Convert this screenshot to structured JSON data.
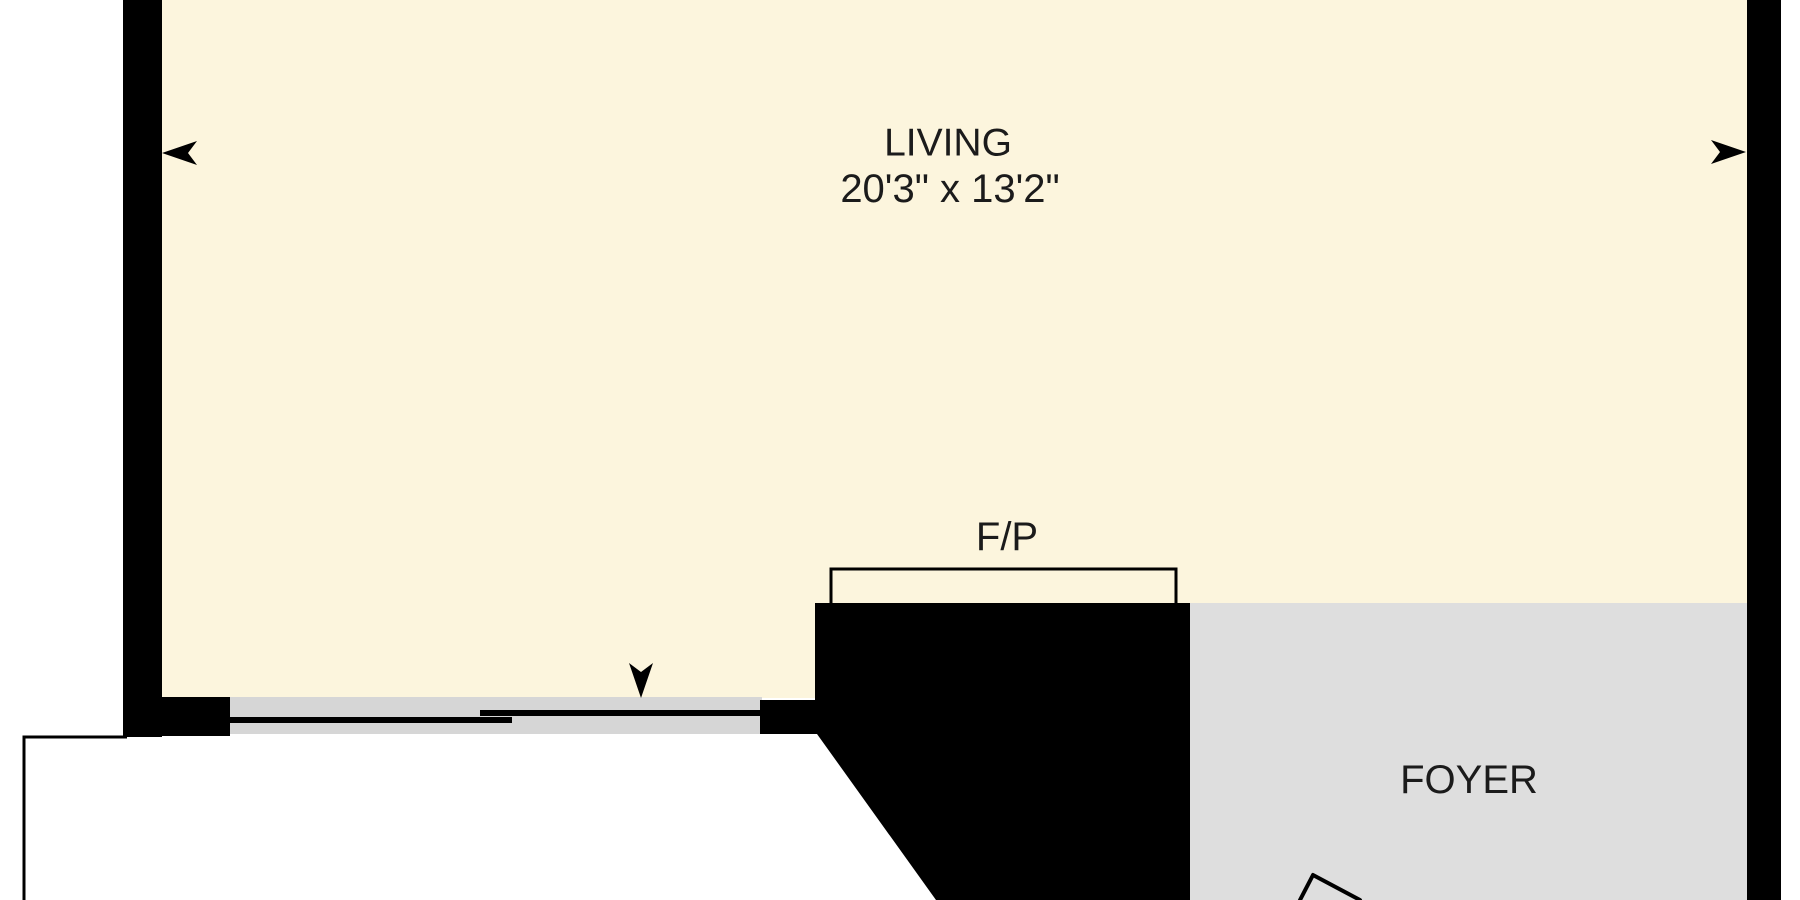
{
  "floor_plan": {
    "rooms": {
      "living": {
        "label": "LIVING",
        "dimensions": "20'3\" x 13'2\""
      },
      "foyer": {
        "label": "FOYER"
      }
    },
    "fireplace": {
      "label": "F/P"
    },
    "icons": [
      "window-arrow-left-icon",
      "window-arrow-right-icon",
      "entry-arrow-down-icon",
      "door-swing-icon"
    ],
    "colors": {
      "living_fill": "#FCF5DD",
      "foyer_fill": "#DEDEDE",
      "door_opening_fill": "#D6D6D6",
      "wall": "#000000",
      "label_text": "#1B1B1B",
      "background": "#FFFFFF"
    }
  }
}
